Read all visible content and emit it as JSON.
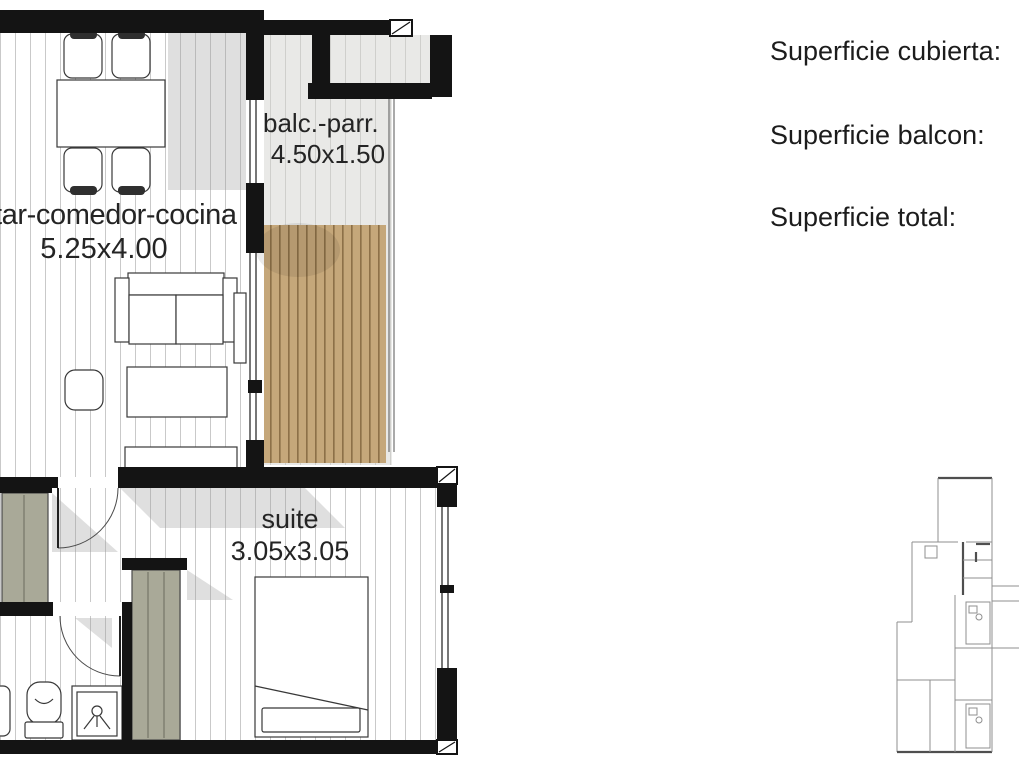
{
  "colors": {
    "wall": "#141414",
    "wood_deck": "#c5a77a",
    "deck_stripe": "#8d7048",
    "closet": "#a9a998",
    "floor_line": "#c9c9c9",
    "tile_line": "#cfcfcc",
    "balcony_floor": "#e9e9e7",
    "shadow": "#9a9a9a",
    "text": "#242424",
    "keyplan_line": "#8f8f8f",
    "keyplan_bold": "#4f4f4f"
  },
  "summary": {
    "items": [
      {
        "label": "Superficie cubierta:"
      },
      {
        "label": "Superficie balcon:"
      },
      {
        "label": "Superficie total:"
      }
    ]
  },
  "floor_plan": {
    "rooms": [
      {
        "label": "tar-comedor-cocina",
        "dimensions": "5.25x4.00"
      },
      {
        "label": "balc.-parr.",
        "dimensions": "4.50x1.50"
      },
      {
        "label": "suite",
        "dimensions": "3.05x3.05"
      }
    ]
  }
}
